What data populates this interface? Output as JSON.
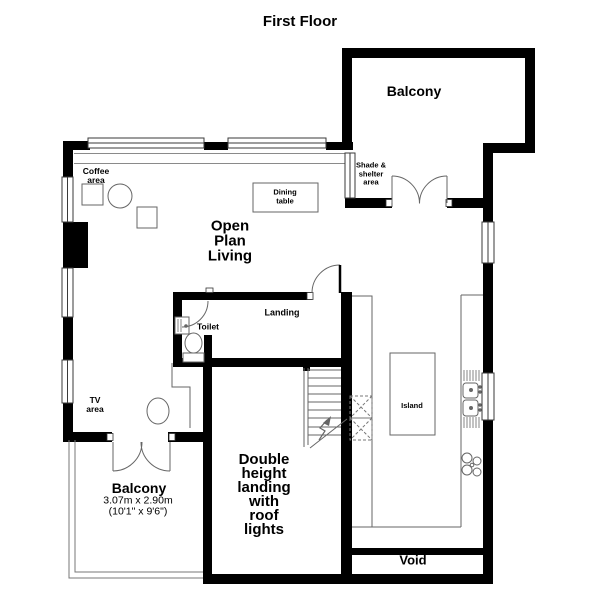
{
  "title": "First Floor",
  "colors": {
    "wall": "#000000",
    "line": "#666666",
    "text": "#000000",
    "background": "#ffffff"
  },
  "rooms": {
    "balcony_top": {
      "label": "Balcony"
    },
    "shade_shelter": {
      "label": "Shade &\nshelter\narea"
    },
    "open_plan": {
      "label": "Open\nPlan\nLiving"
    },
    "coffee": {
      "label": "Coffee\narea"
    },
    "dining": {
      "label": "Dining\ntable"
    },
    "landing": {
      "label": "Landing"
    },
    "toilet": {
      "label": "Toilet"
    },
    "tv": {
      "label": "TV\narea"
    },
    "balcony_bottom": {
      "label": "Balcony",
      "dimensions_metric": "3.07m x 2.90m",
      "dimensions_imperial": "(10'1\" x 9'6\")"
    },
    "double_height": {
      "label": "Double\nheight\nlanding\nwith\nroof\nlights"
    },
    "island": {
      "label": "Island"
    },
    "void": {
      "label": "Void"
    }
  }
}
